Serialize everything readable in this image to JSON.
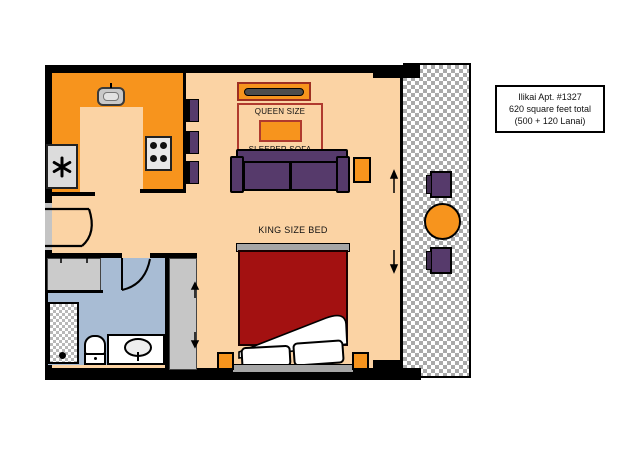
{
  "info_box": {
    "lines": [
      "Ilikai Apt. #1327",
      "620 square feet total",
      "(500 + 120 Lanai)"
    ]
  },
  "labels": {
    "sofa_top": "QUEEN SIZE",
    "sofa_bottom": "SLEEPER SOFA",
    "bed": "KING SIZE BED"
  },
  "colors": {
    "floor": "#FBD3A4",
    "counter_orange": "#F7941D",
    "furniture_purple": "#563A6B",
    "bed_red": "#A31111",
    "bath_floor_blue": "#A8BCD4",
    "label_border_red": "#B03A2E",
    "wall_black": "#000000"
  }
}
